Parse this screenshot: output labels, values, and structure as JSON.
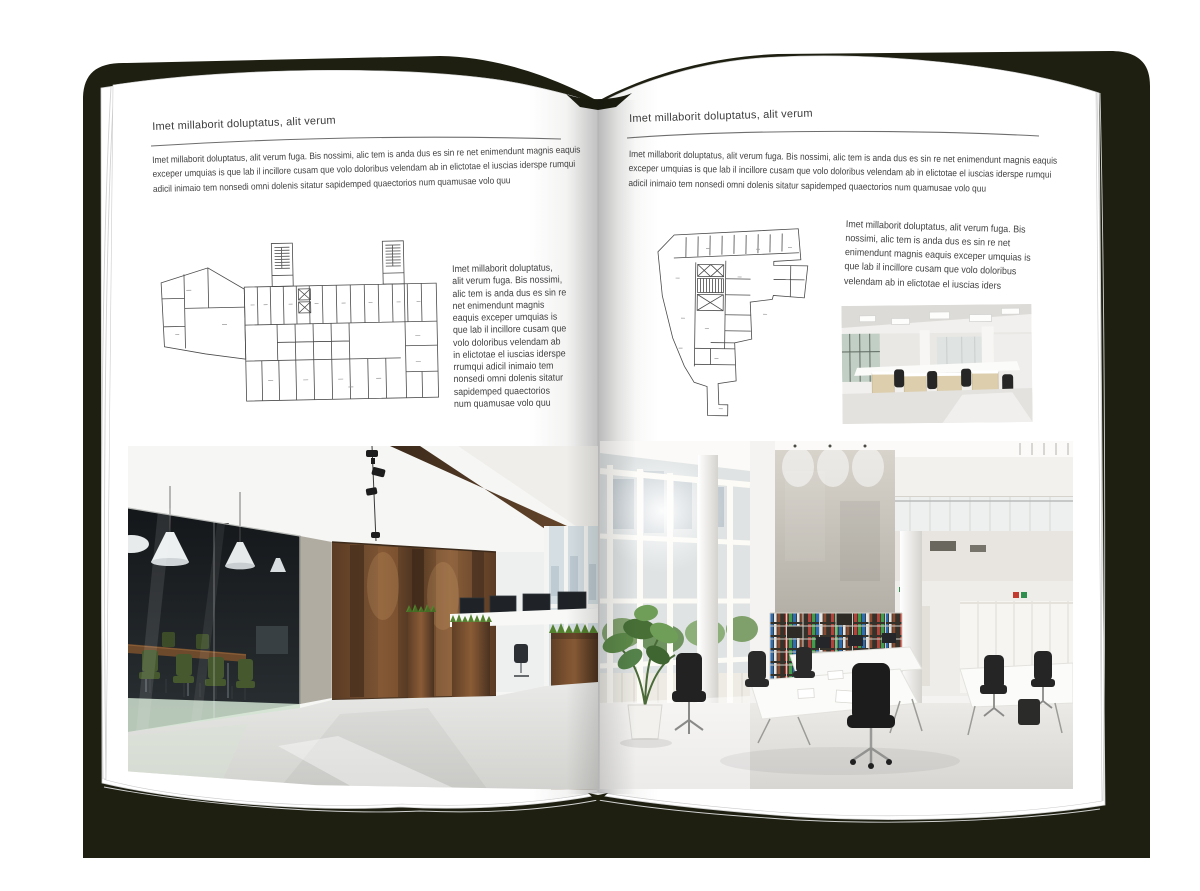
{
  "book": {
    "colors": {
      "canvas_background": "#ffffff",
      "book_cover": "#1e1f11",
      "page": "#ffffff",
      "body_text": "#414141",
      "header_rule": "#6e6e6e",
      "floorplan_line": "#4a4a4a",
      "wood_accent": "#7b5434",
      "plant_green": "#55822f",
      "binder_red": "#b3433a",
      "binder_green": "#3f9e4d",
      "binder_blue": "#2e6db4"
    },
    "left_page": {
      "header": "Imet millaborit doluptatus, alit verum",
      "intro": "Imet millaborit doluptatus, alit verum fuga. Bis nossimi, alic tem is anda dus es sin re net enimendunt magnis eaquis exceper umquias is que lab il incillore cusam que volo doloribus velendam ab in elictotae el iuscias iderspe rumqui adicil inimaio tem nonsedi omni dolenis sitatur sapidemped quaectorios num quamusae volo quu",
      "side_text": "Imet millaborit doluptatus, alit verum fuga. Bis nossimi, alic tem is anda dus es sin re net enimendunt magnis eaquis exceper umquias is que lab il incillore cusam que volo doloribus velendam ab in elictotae el iuscias iderspe rrumqui adicil inimaio tem nonsedi omni dolenis sitatur sapidemped quaectorios num quamusae volo quu",
      "floorplan_name": "wide-building-floor-plan",
      "photo_name": "office-interior-glass-meeting-room-wood-wall"
    },
    "right_page": {
      "header": "Imet millaborit doluptatus, alit verum",
      "intro": "Imet millaborit doluptatus, alit verum fuga. Bis nossimi, alic tem is anda dus es sin re net enimendunt magnis eaquis exceper umquias is que lab il incillore cusam que volo doloribus velendam ab in elictotae el iuscias iderspe rumqui adicil inimaio tem nonsedi omni dolenis sitatur sapidemped quaectorios num quamusae volo quu",
      "side_text": "Imet millaborit doluptatus, alit verum fuga. Bis nossimi, alic tem is anda dus es sin re net enimendunt magnis eaquis exceper umquias is que lab il incillore cusam que volo doloribus velendam ab in elictotae el iuscias iders",
      "floorplan_name": "irregular-building-floor-plan",
      "photo_small_name": "bright-open-office-photo",
      "photo_large_name": "white-atrium-office-photo"
    }
  }
}
